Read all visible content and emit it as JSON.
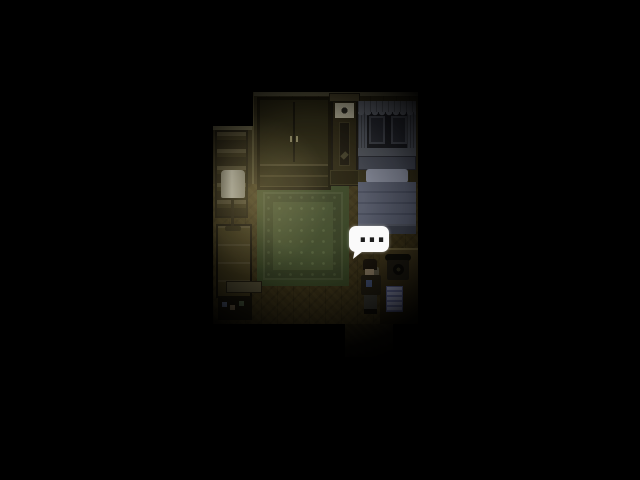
{
  "screen": {
    "width": 640,
    "height": 480,
    "background": "#000000",
    "description": "Dark pixel-art RPG bedroom scene surrounded by black vignette; warm lamp light on the left, cool moonlit bed on the right"
  },
  "speech_bubble": {
    "text": "...",
    "background": "#fafafa",
    "dot_color": "#1c1c1c"
  },
  "room": {
    "objects": [
      {
        "label": "bookshelf"
      },
      {
        "label": "floor lamp"
      },
      {
        "label": "dresser"
      },
      {
        "label": "wardrobe"
      },
      {
        "label": "grandfather clock"
      },
      {
        "label": "curtained window"
      },
      {
        "label": "bed with pillow and blanket"
      },
      {
        "label": "patterned rug"
      },
      {
        "label": "desk"
      },
      {
        "label": "rotary telephone"
      },
      {
        "label": "note paper"
      },
      {
        "label": "bench with small items"
      },
      {
        "label": "hallway exit"
      },
      {
        "label": "character"
      }
    ]
  },
  "palette": {
    "wall": "#2b2614",
    "floor": "#332b14",
    "rug": "#3b4628",
    "bed_blanket": "#4e5364",
    "pillow": "#7b8090",
    "lamp_shade": "#b3ae93",
    "lamp_glow": "#ffe48c",
    "paper": "#8a90ae",
    "bubble": "#fafafa"
  }
}
